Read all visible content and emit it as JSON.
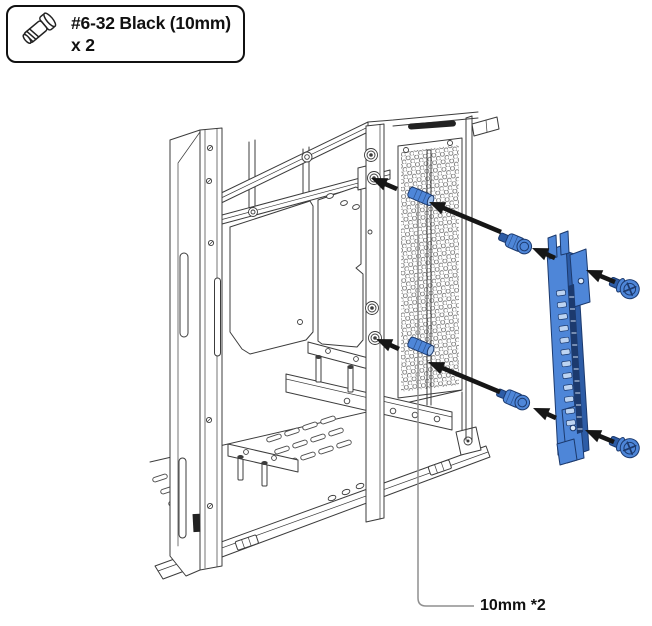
{
  "callout": {
    "icon": "screw-icon",
    "line1": "#6-32 Black (10mm)",
    "line2": "x 2"
  },
  "annotation": {
    "label": "10mm *2"
  },
  "colors": {
    "part-blue": "#4e86d8",
    "part-blue-dark": "#2d5ca6",
    "part-blue-deep": "#1c3a6e",
    "part-blue-light": "#9fc0ec",
    "line": "#3c3c3c",
    "arrow": "#161616",
    "leader": "#8f8f8f",
    "ink": "#111111",
    "background": "#ffffff"
  }
}
